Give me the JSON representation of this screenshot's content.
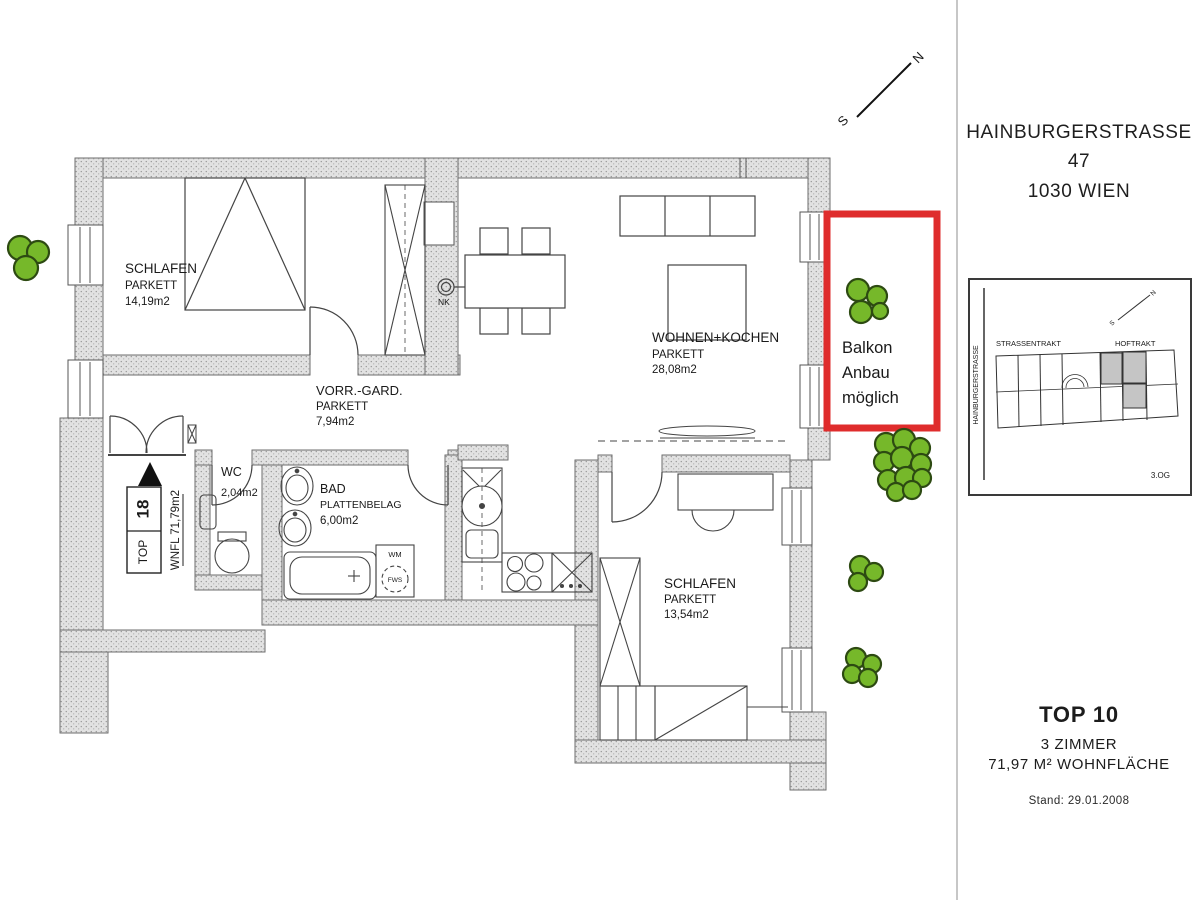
{
  "colors": {
    "accent_red": "#df2c2c",
    "tree_green": "#76b82a"
  },
  "plan": {
    "rooms": {
      "schlafen1": {
        "name": "SCHLAFEN",
        "floor": "PARKETT",
        "area": "14,19m2"
      },
      "wohnen_kochen": {
        "name": "WOHNEN+KOCHEN",
        "floor": "PARKETT",
        "area": "28,08m2"
      },
      "vorraum": {
        "name": "VORR.-GARD.",
        "floor": "PARKETT",
        "area": "7,94m2"
      },
      "wc": {
        "name": "WC",
        "area": "2,04m2"
      },
      "bad": {
        "name": "BAD",
        "floor": "PLATTENBELAG",
        "area": "6,00m2"
      },
      "schlafen2": {
        "name": "SCHLAFEN",
        "floor": "PARKETT",
        "area": "13,54m2"
      }
    },
    "unit_marker": {
      "top_label": "TOP",
      "top_number": "18",
      "wnfl": "WNFL  71,79m2"
    },
    "annotations": {
      "balkon_line1": "Balkon",
      "balkon_line2": "Anbau",
      "balkon_line3": "möglich",
      "nk": "NK",
      "wm": "WM",
      "fws": "FWS"
    },
    "compass": {
      "north": "N",
      "south": "S"
    }
  },
  "sidebar": {
    "address_line1": "HAINBURGERSTRASSE 47",
    "address_line2": "1030 WIEN",
    "site_inset": {
      "street_label": "HAINBURGERSTRASSE",
      "wing_left": "STRASSENTRAKT",
      "wing_right": "HOFTRAKT",
      "floor_label": "3.OG",
      "north": "N",
      "south": "S"
    },
    "unit_info": {
      "title": "TOP 10",
      "rooms": "3 ZIMMER",
      "area": "71,97 M² WOHNFLÄCHE",
      "stand": "Stand: 29.01.2008"
    }
  }
}
